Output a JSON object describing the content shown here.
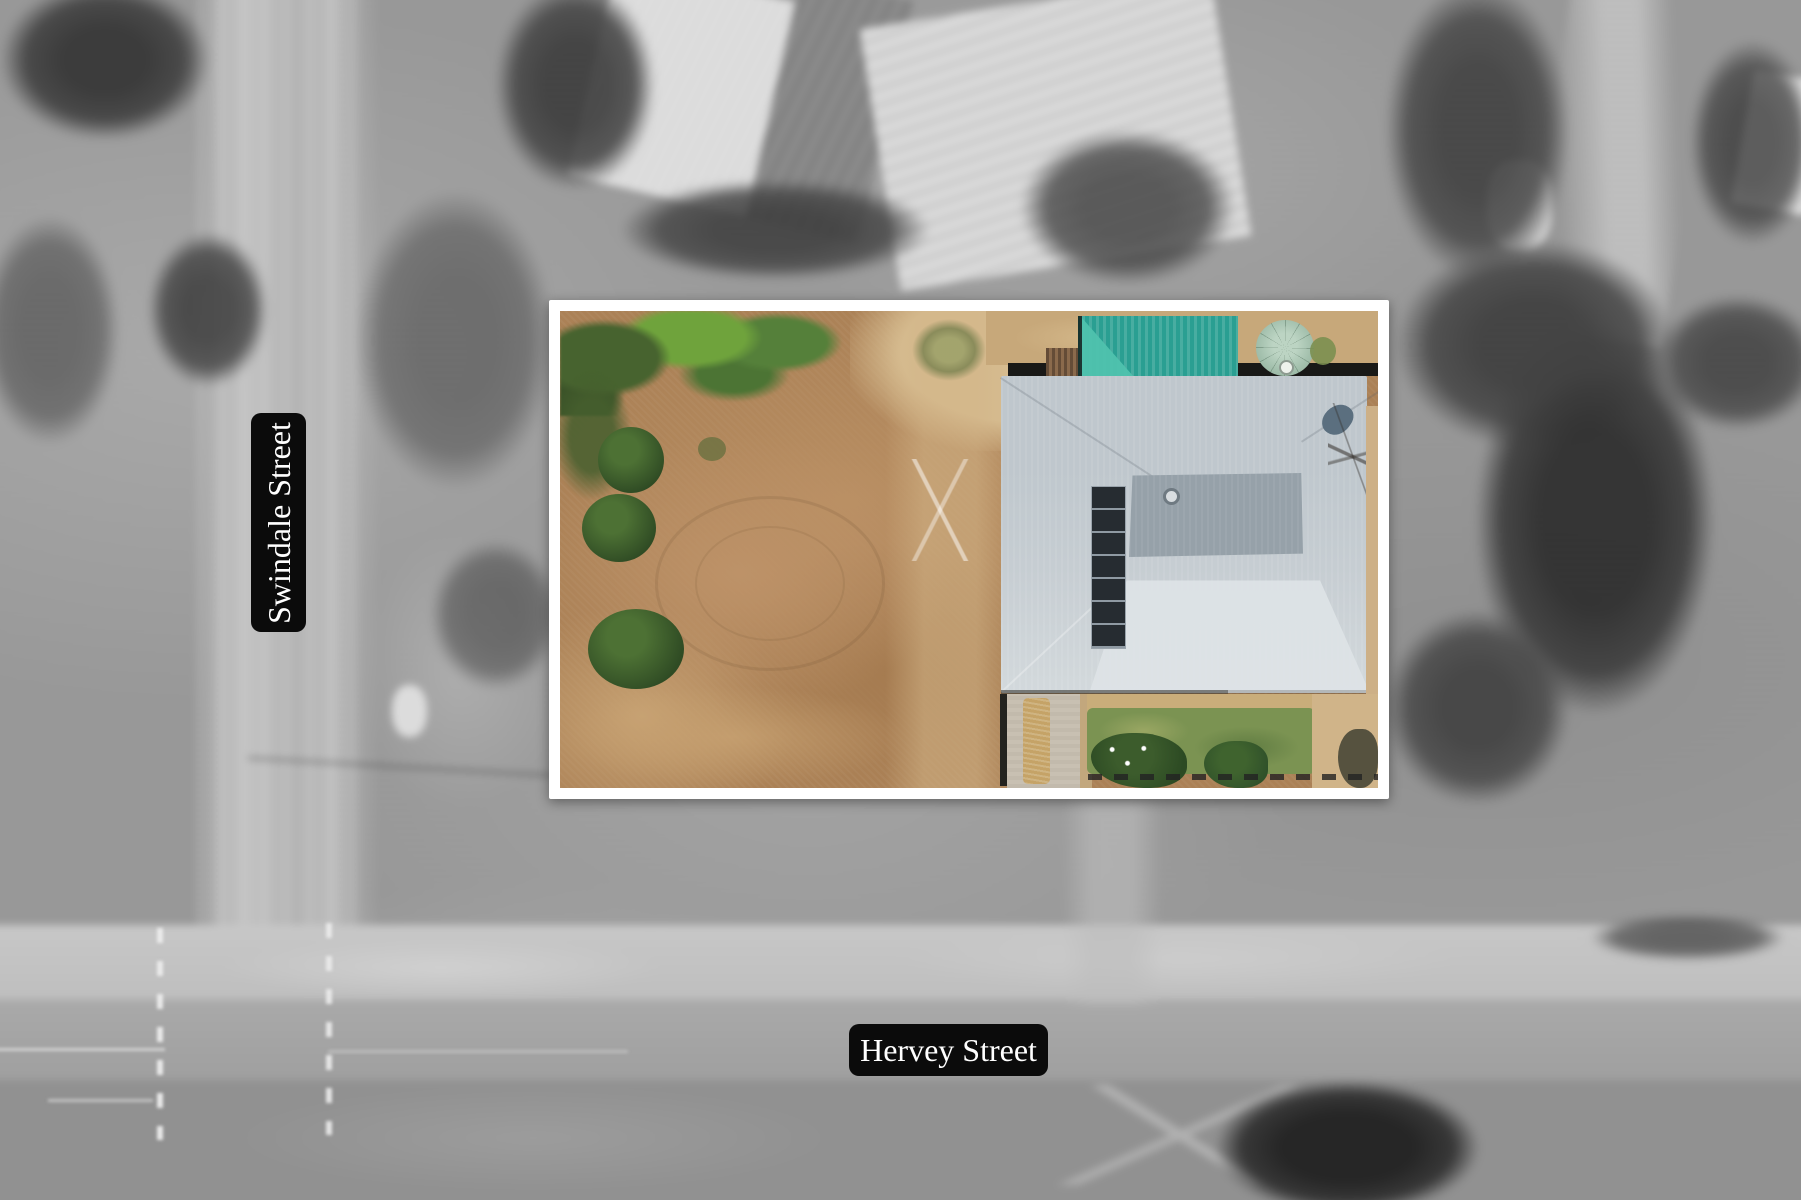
{
  "street_labels": {
    "vertical": "Swindale Street",
    "horizontal": "Hervey Street"
  },
  "colors": {
    "label_background": "#0b0b0b",
    "label_text": "#ffffff",
    "highlight_frame": "#ffffff",
    "roof_light": "#c6cdd2",
    "roof_dark": "#96a1a9",
    "solar_panels": "#262c31",
    "pool_cover_teal": "#2a9f92",
    "water_tank_green": "#a3c0ad",
    "dirt_yard": "#ab8156",
    "lawn_green": "#7b9352",
    "tree_green": "#3f6130",
    "aerial_gray": "#9a9a9a"
  },
  "features": [
    "highlighted-property-lot",
    "house-roof",
    "solar-panel-array",
    "pool-shade-cover",
    "water-tank",
    "dirt-yard",
    "green-lawn",
    "garden-path",
    "vertical-street",
    "horizontal-street",
    "surrounding-trees",
    "neighboring-roofs",
    "road-lane-markings"
  ]
}
